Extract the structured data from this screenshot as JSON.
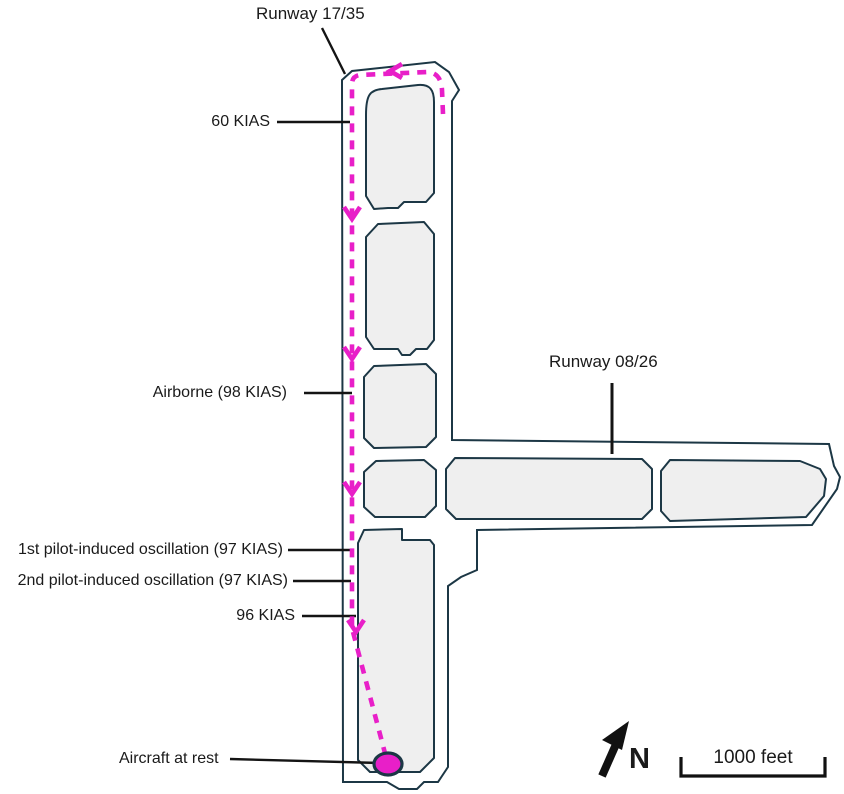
{
  "figure": {
    "type": "airport-runway-accident-diagram",
    "labels": {
      "runway_17_35": "Runway 17/35",
      "kias_60": "60 KIAS",
      "airborne_98": "Airborne (98 KIAS)",
      "runway_08_26": "Runway 08/26",
      "oscillation_1": "1st pilot-induced oscillation (97 KIAS)",
      "oscillation_2": "2nd pilot-induced oscillation (97 KIAS)",
      "kias_96": "96 KIAS",
      "aircraft_at_rest": "Aircraft at rest",
      "north_indicator": "N",
      "scale_bar": "1000 feet"
    },
    "colors": {
      "flight_path": "#e81fc8",
      "outline": "#1c3745",
      "pad_fill": "#efefef",
      "annotation_text": "#1a1a1a"
    }
  }
}
